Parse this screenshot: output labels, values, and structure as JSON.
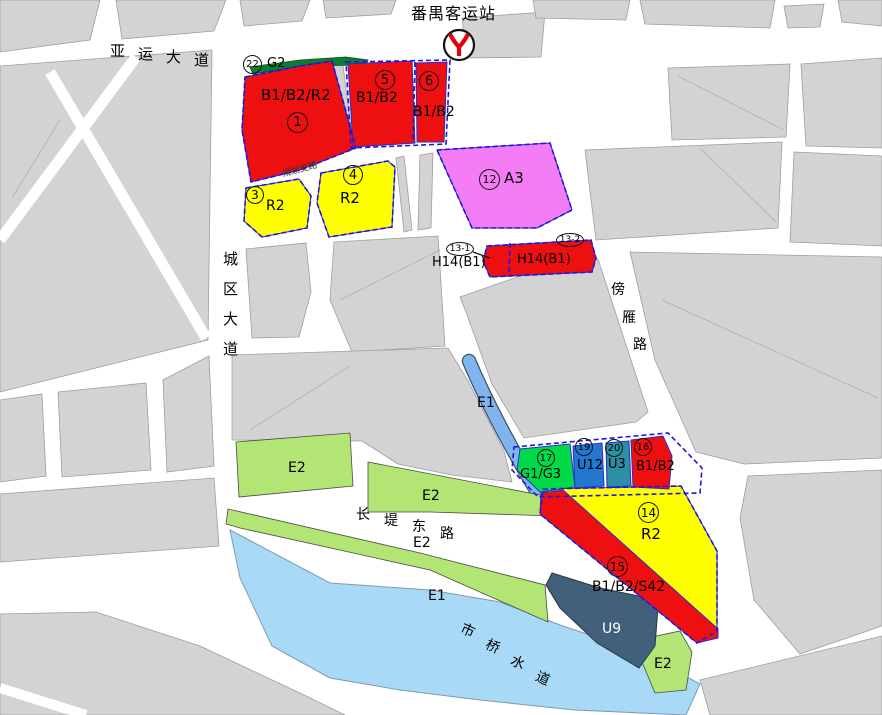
{
  "station": {
    "name": "番禺客运站",
    "icon": "guangzhou-metro-icon"
  },
  "roads": {
    "yayun": {
      "name": "亚运大道",
      "chars": [
        "亚",
        "运",
        "大",
        "道"
      ]
    },
    "chengqu": {
      "name": "城区大道",
      "chars": [
        "城",
        "区",
        "大",
        "道"
      ]
    },
    "bangyan": {
      "name": "傍雁路",
      "chars": [
        "傍",
        "雁",
        "路"
      ]
    },
    "changdi": {
      "name": "长堤东路",
      "chars": [
        "长",
        "堤",
        "东",
        "路"
      ]
    },
    "shiqiao": {
      "name": "市桥水道",
      "chars": [
        "市",
        "桥",
        "水",
        "道"
      ]
    },
    "planned_branch": {
      "name": "规划支路"
    }
  },
  "parcels": {
    "p1": {
      "num": "1",
      "code": "B1/B2/R2"
    },
    "p3": {
      "num": "3",
      "code": "R2"
    },
    "p4": {
      "num": "4",
      "code": "R2"
    },
    "p5": {
      "num": "5",
      "code": "B1/B2"
    },
    "p6": {
      "num": "6",
      "code": "B1/B2"
    },
    "p12": {
      "num": "12",
      "code": "A3"
    },
    "p13_1": {
      "num": "13-1",
      "code": "H14(B1)"
    },
    "p13_2": {
      "num": "13-2",
      "code": "H14(B1)"
    },
    "p14": {
      "num": "14",
      "code": "R2"
    },
    "p15": {
      "num": "15",
      "code": "B1/B2/S42"
    },
    "p16": {
      "num": "16",
      "code": "B1/B2"
    },
    "p17": {
      "num": "17",
      "code": "G1/G3"
    },
    "p19": {
      "num": "19",
      "code": "U12"
    },
    "p20": {
      "num": "20",
      "code": "U3"
    },
    "p22": {
      "num": "22",
      "code": "G2"
    }
  },
  "areas": {
    "e1_canal": "E1",
    "e1_river": "E1",
    "e2_left": "E2",
    "e2_mid": "E2",
    "e2_bank": "E2",
    "e2_corner": "E2",
    "u9": "U9"
  },
  "colors": {
    "red": "#ee1010",
    "yellow": "#ffff00",
    "pink": "#f47cf4",
    "green_bright": "#00d948",
    "green_light": "#b2e573",
    "green_dark": "#0e7d2e",
    "blue_u12": "#2377cf",
    "teal_u3": "#2b90a4",
    "water": "#a8d9f6",
    "canal": "#80b4ee",
    "slate_u9": "#42607a",
    "gray_block": "#d3d3d3",
    "boundary_blue": "#1818e0",
    "metro_red": "#e60012"
  }
}
